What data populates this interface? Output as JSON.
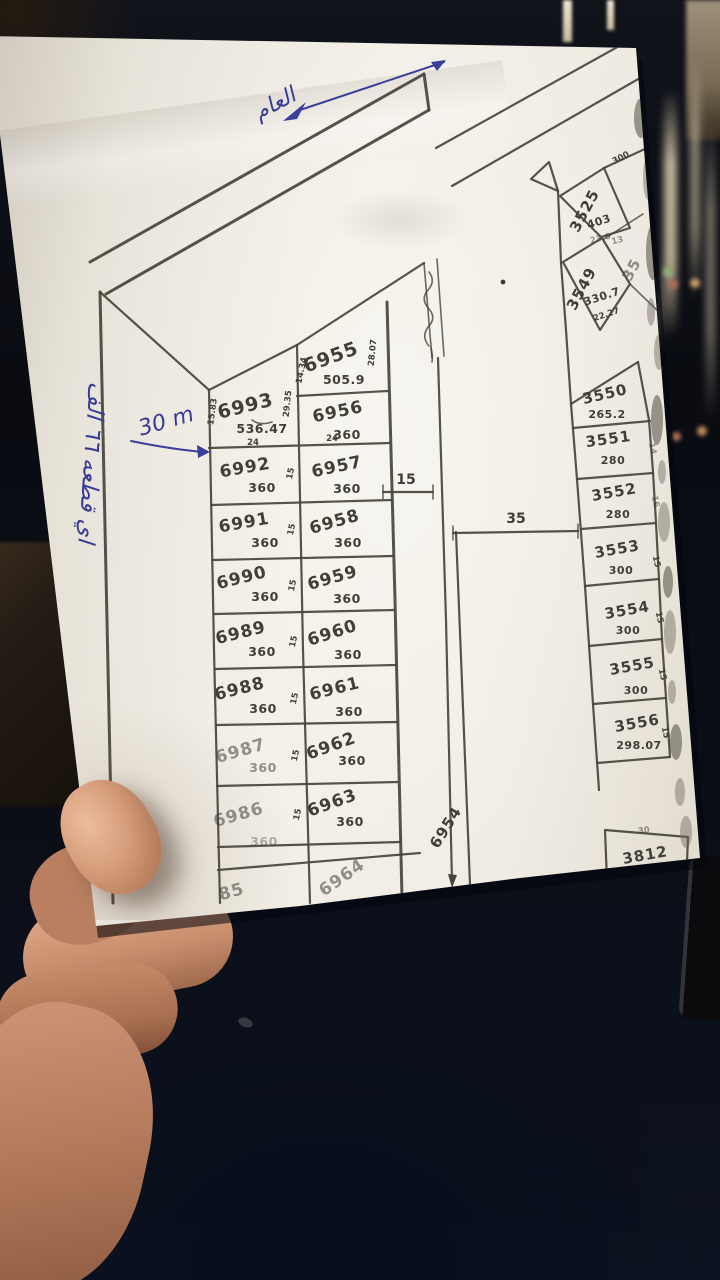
{
  "handwritten": {
    "top_note": "العام",
    "left_note": "اي قطعه ٦٦ الف",
    "width_note": "30 m"
  },
  "map": {
    "west_block": {
      "column_a": [
        {
          "id": "6993",
          "area": "536.47"
        },
        {
          "id": "6992",
          "area": "360"
        },
        {
          "id": "6991",
          "area": "360"
        },
        {
          "id": "6990",
          "area": "360"
        },
        {
          "id": "6989",
          "area": "360"
        },
        {
          "id": "6988",
          "area": "360"
        },
        {
          "id": "6987",
          "area": "360"
        },
        {
          "id": "6986",
          "area": "360"
        },
        {
          "id": "85",
          "area": ""
        }
      ],
      "column_b": [
        {
          "id": "6955",
          "area": "505.9"
        },
        {
          "id": "6956",
          "area": "360"
        },
        {
          "id": "6957",
          "area": "360"
        },
        {
          "id": "6958",
          "area": "360"
        },
        {
          "id": "6959",
          "area": "360"
        },
        {
          "id": "6960",
          "area": "360"
        },
        {
          "id": "6961",
          "area": "360"
        },
        {
          "id": "6962",
          "area": "360"
        },
        {
          "id": "6963",
          "area": "360"
        },
        {
          "id": "6964",
          "area": ""
        }
      ],
      "row_width": "15",
      "top_widths": [
        "24",
        "24"
      ],
      "edges": {
        "e6993_left": "15.83",
        "e6993_right": "29.35",
        "e6955_left": "14.34",
        "e6955_right": "28.07"
      }
    },
    "east_block": {
      "plots": [
        {
          "id": "3550",
          "area": "265.2"
        },
        {
          "id": "3551",
          "area": "280"
        },
        {
          "id": "3552",
          "area": "280"
        },
        {
          "id": "3553",
          "area": "300"
        },
        {
          "id": "3554",
          "area": "300"
        },
        {
          "id": "3555",
          "area": "300"
        },
        {
          "id": "3556",
          "area": "298.07"
        }
      ],
      "side_width": "15",
      "side_edges": [
        "14",
        "16"
      ]
    },
    "north_plots": {
      "p3525": {
        "id": "3525",
        "area": "403"
      },
      "p3549": {
        "id": "3549",
        "area": "330.7"
      },
      "partial_id": "35",
      "edges": {
        "top": "300",
        "a": "23.6",
        "b": "13",
        "bottom": "22.27"
      }
    },
    "road_strip_id": "6954",
    "south_plot": {
      "id": "3812",
      "edge": "30"
    },
    "road_widths": {
      "narrow": "15",
      "wide": "35"
    }
  },
  "colors": {
    "ink": "#46453b",
    "pen": "#3b3f9a",
    "paper": "#ece7dd",
    "table": "#1e3c66"
  }
}
